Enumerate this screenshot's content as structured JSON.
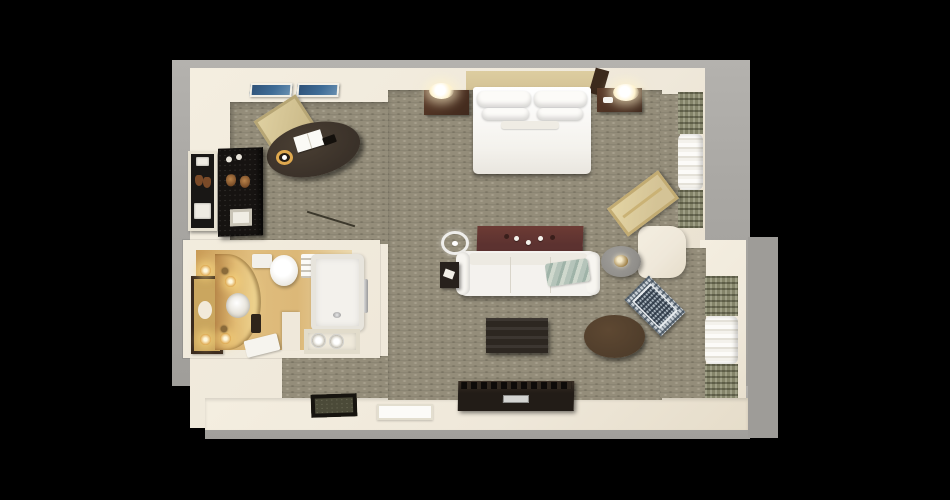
{
  "scene": {
    "type": "3d-floorplan-top-view",
    "description": "Top-down 3D rendering of a hotel suite floor plan on a black background",
    "rooms": {
      "bedroom": "Bedroom area with king bed",
      "living": "Living area with sofa and TV console",
      "bathroom": "Bathroom with vanity, toilet and bathtub",
      "work": "Work corner with oval desk and chair",
      "closet": "Closet and minibar alcove",
      "entry": "Entry hall with doormat and door"
    }
  },
  "furniture": {
    "bed": "King bed with white linens and four pillows",
    "headboard": "Tan upholstered headboard",
    "nightstand_left": "Left nightstand",
    "nightstand_right": "Right nightstand",
    "lamp_left": "Left bedside lamp (lit)",
    "lamp_right": "Right bedside lamp (lit)",
    "phone": "Telephone on right nightstand",
    "bench": "Beige chaise bench by bedroom window",
    "desk": "Dark oval work desk",
    "desk_chair": "Beige desk chair",
    "desk_paper": "Open notepad on desk",
    "desk_cup": "Cup on desk",
    "desk_phone": "Phone on desk",
    "artwork_1": "Framed blue artwork",
    "artwork_2": "Framed blue artwork",
    "closet_shelf": "Closet shelving unit",
    "minibar": "Minibar cabinet with granite top",
    "sofa": "White three-seat sofa",
    "throw": "Sage green throw blanket",
    "console_table": "Mahogany console table behind sofa",
    "end_table": "Dark end table with paper",
    "side_table": "Round side table with lamp",
    "coffee_table": "Dark wood coffee table",
    "ottoman": "Round leather ottoman",
    "accent_chair": "Patterned accent armchair",
    "tv_console": "TV console dresser with silver handle",
    "ceiling_light": "Ceiling light symbol",
    "floor_lamp": "Floor lamp pole",
    "vanity": "Curved golden vanity counter",
    "vanity_mirror": "Framed vanity mirror",
    "sink": "Vanity sink",
    "vanity_lights": "Glowing vanity light bulbs",
    "toilet": "Toilet",
    "bathtub": "Bathtub with chrome fixtures",
    "shelf_towels": "Folded towels on shelf",
    "towel_cubby": "Towel cubby with rolled towels",
    "bath_mat": "White bath mat",
    "doormat": "Dark entry doormat",
    "door": "Entry door",
    "drapes": "Patterned window drapes",
    "sheers": "White sheer curtains"
  },
  "colors": {
    "background": "#000000",
    "slab": "#a8a6a2",
    "slab_right": "#9e9c98",
    "wall": "#efe8da",
    "carpet": "#948d7a",
    "bath_floor": "#dcb878",
    "bath_gold": "#c89a55",
    "vanity": "#e2bc74",
    "mirror_frame": "#3a2a1d",
    "glow": "#fff3cf",
    "glow_ring": "#dfa94f",
    "tan": "#d4c396",
    "wood_dark": "#3a3129",
    "wood_night": "#40291d",
    "wood_black": "#2d2721",
    "tv": "#221c17",
    "cabinet": "#161311",
    "maroon": "#5c3230",
    "white_soft": "#f4f2ee",
    "teal": "#b5c4ba",
    "drape": "#84846a",
    "chair_pat": "#c7ced4",
    "ottoman": "#4f3d2b",
    "art_blue": "#3f6c96",
    "gray_circle": "#8f8d89",
    "mat_border": "#17140f",
    "mat_field": "#4b4a38"
  }
}
